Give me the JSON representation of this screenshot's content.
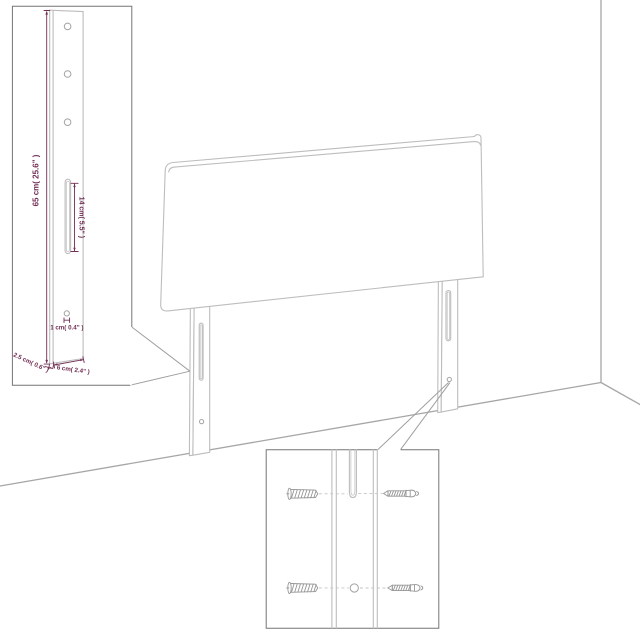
{
  "illustration": {
    "subject": "headboard with two mounting legs in a room corner",
    "colors": {
      "background": "#ffffff",
      "furniture_outline": "#bdbdbd",
      "wall_line": "#a6a6a6",
      "inset_border": "#757575",
      "dimension_accent": "#722e54"
    },
    "leg_detail_inset": {
      "height_label": "65 cm( 25.6\" )",
      "slot_label": "14 cm( 5.5\" )",
      "hole_label": "1 cm( 0.4\" )",
      "depth_label": "2.5 cm( 0.6\" )",
      "width_label": "6 cm( 2.4\" )"
    },
    "hardware_inset": {
      "items": [
        "wall-plug",
        "screw"
      ]
    }
  }
}
